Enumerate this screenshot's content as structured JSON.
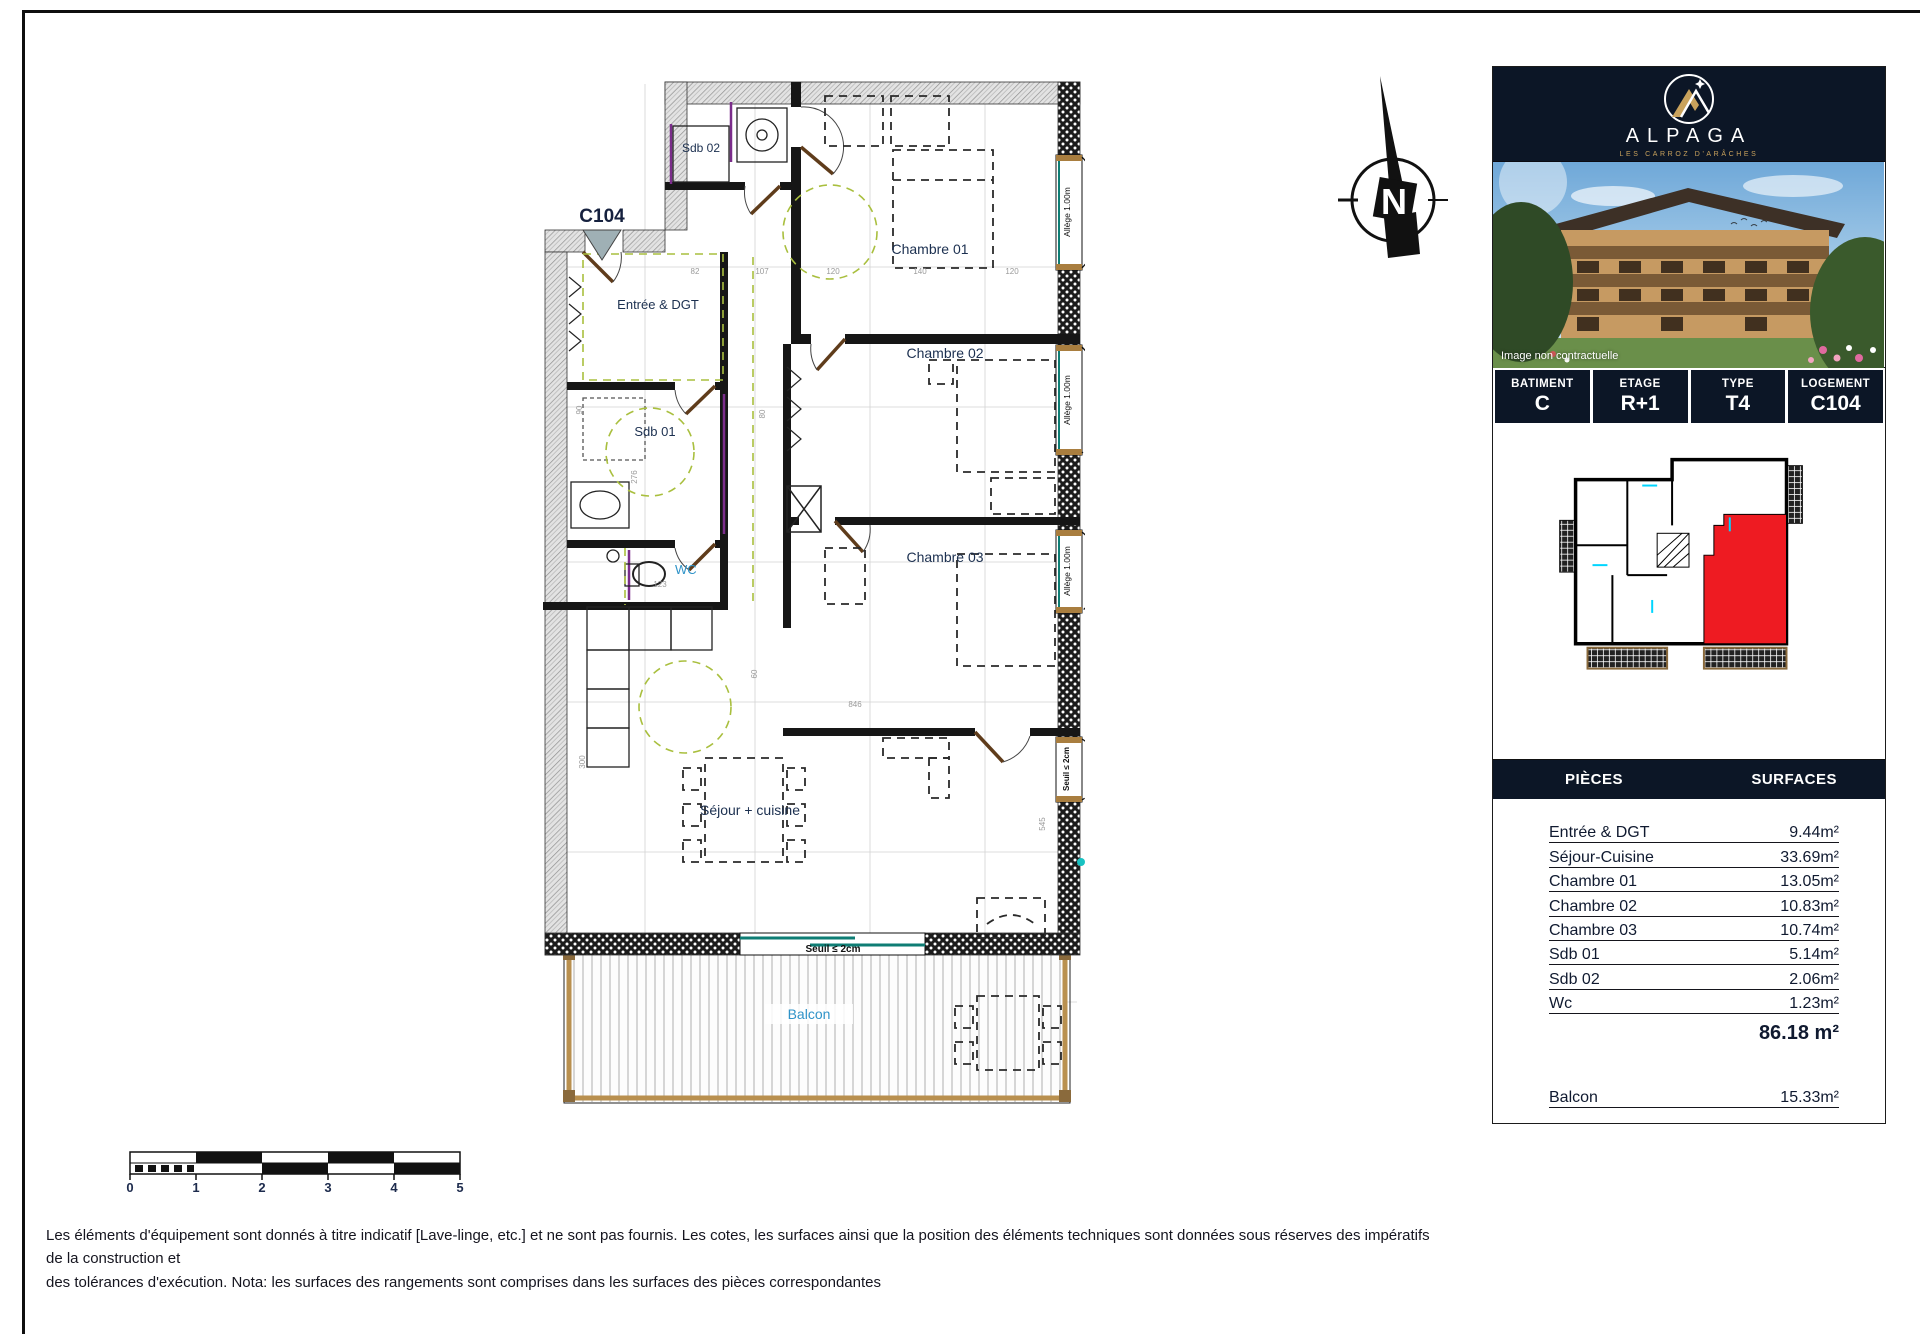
{
  "colors": {
    "panel_dark": "#0c1626",
    "gold": "#c9a25c",
    "highlight_red": "#ee1b22",
    "label_navy": "#1c3050",
    "label_blue": "#2f93c8",
    "door_brown": "#5f3c1b",
    "wood_tan": "#b9904f",
    "green_dash": "#a9bf3e",
    "teal": "#0e7d74"
  },
  "compass": {
    "label": "N"
  },
  "plan": {
    "unit": "C104",
    "rooms": {
      "sdb02": "Sdb 02",
      "chambre01": "Chambre 01",
      "chambre02": "Chambre 02",
      "chambre03": "Chambre 03",
      "entree": "Entrée & DGT",
      "sdb01": "Sdb 01",
      "wc": "WC",
      "sejour": "Séjour + cuisine",
      "balcon": "Balcon"
    },
    "window_sill": "Allège 1.00m",
    "threshold": "Seuil ≤ 2cm",
    "dims": [
      "82",
      "107",
      "120",
      "140",
      "120",
      "90",
      "276",
      "80",
      "123",
      "60",
      "300",
      "846",
      "545"
    ]
  },
  "scalebar": {
    "ticks": [
      "0",
      "1",
      "2",
      "3",
      "4",
      "5"
    ]
  },
  "sidebar": {
    "brand": {
      "name": "ALPAGA",
      "tagline": "LES CARROZ D'ARÂCHES"
    },
    "photo_caption": "Image non contractuelle",
    "info": [
      {
        "label": "BATIMENT",
        "value": "C"
      },
      {
        "label": "ETAGE",
        "value": "R+1"
      },
      {
        "label": "TYPE",
        "value": "T4"
      },
      {
        "label": "LOGEMENT",
        "value": "C104"
      }
    ],
    "surfaces": {
      "header": {
        "pieces": "PIÈCES",
        "surfaces": "SURFACES"
      },
      "rows": [
        {
          "label": "Entrée & DGT",
          "value": "9.44m²"
        },
        {
          "label": "Séjour-Cuisine",
          "value": "33.69m²"
        },
        {
          "label": "Chambre 01",
          "value": "13.05m²"
        },
        {
          "label": "Chambre 02",
          "value": "10.83m²"
        },
        {
          "label": "Chambre 03",
          "value": "10.74m²"
        },
        {
          "label": "Sdb 01",
          "value": "5.14m²"
        },
        {
          "label": "Sdb 02",
          "value": "2.06m²"
        },
        {
          "label": "Wc",
          "value": "1.23m²"
        }
      ],
      "total": "86.18 m²",
      "balcony": {
        "label": "Balcon",
        "value": "15.33m²"
      }
    }
  },
  "footer": {
    "line1": "Les éléments d'équipement sont donnés à titre indicatif [Lave-linge, etc.] et ne sont pas fournis. Les cotes, les surfaces ainsi que la position des éléments techniques sont données sous réserves des impératifs de la construction et",
    "line2": "des tolérances d'exécution. Nota: les surfaces des rangements sont comprises dans les surfaces des pièces correspondantes"
  }
}
